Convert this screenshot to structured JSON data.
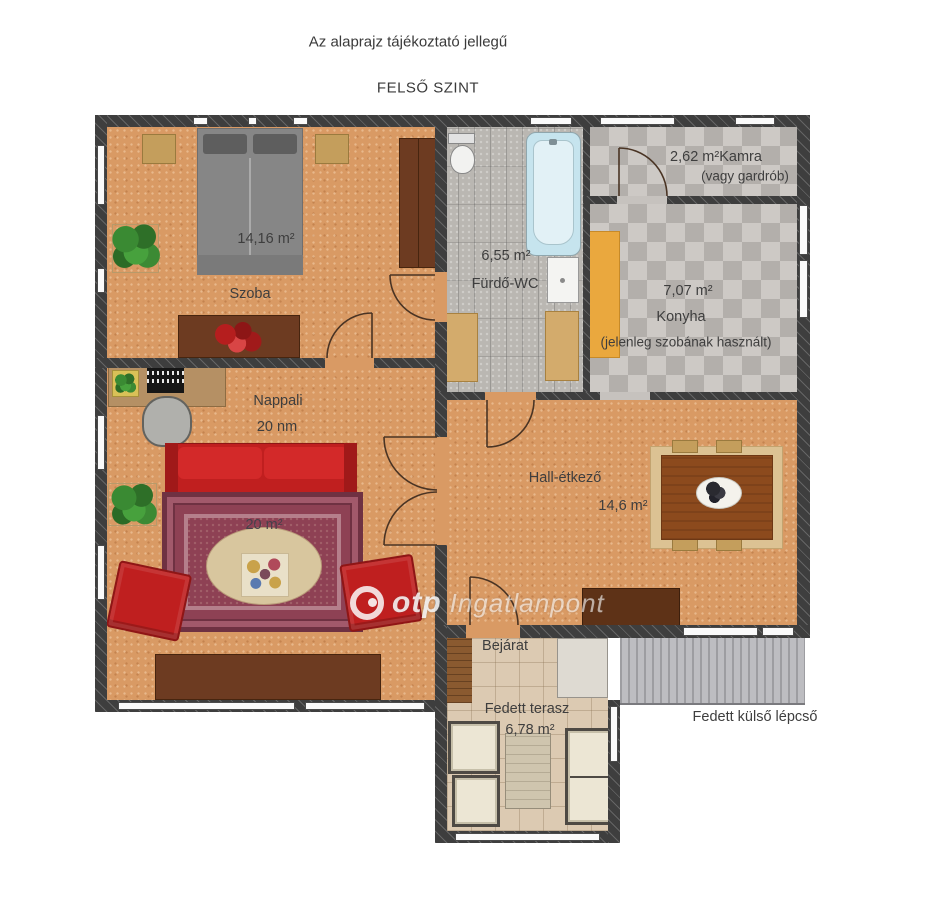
{
  "header": {
    "disclaimer": "Az alaprajz tájékoztató jellegű",
    "floor_label": "FELSŐ SZINT"
  },
  "rooms": {
    "szoba": {
      "area": "14,16 m²",
      "name": "Szoba"
    },
    "furdo_wc": {
      "area": "6,55 m²",
      "name": "Fürdő-WC"
    },
    "kamra": {
      "area": "2,62 m²",
      "name": "Kamra",
      "note": "(vagy gardrób)"
    },
    "konyha": {
      "area": "7,07 m²",
      "name": "Konyha",
      "note": "(jelenleg szobának használt)"
    },
    "nappali": {
      "name": "Nappali",
      "area": "20 nm",
      "rug_label": "20 m²"
    },
    "hall": {
      "name": "Hall-étkező",
      "area": "14,6 m²"
    },
    "bejarat": {
      "name": "Bejárat"
    },
    "terasz": {
      "name": "Fedett terasz",
      "area": "6,78 m²"
    },
    "kulso_lepcso": {
      "name": "Fedett külső lépcső"
    }
  },
  "watermark": {
    "brand": "otp",
    "name": "Ingatlanpont"
  },
  "colors": {
    "wall": "#3e3e3e",
    "floor_wood": "#d99a64",
    "bath_tile": "#bab7b2",
    "kitchen_checker": "#c0bcb8",
    "terrace_tile": "#dccab2",
    "stairs": "#b0b0b4",
    "sofa_red": "#c01f1f",
    "furniture_wood": "#6d3b21",
    "kitchen_cabinet_orange": "#eaa83e",
    "bathtub_blue": "#c6e4ee",
    "text": "#3e3e3e"
  }
}
